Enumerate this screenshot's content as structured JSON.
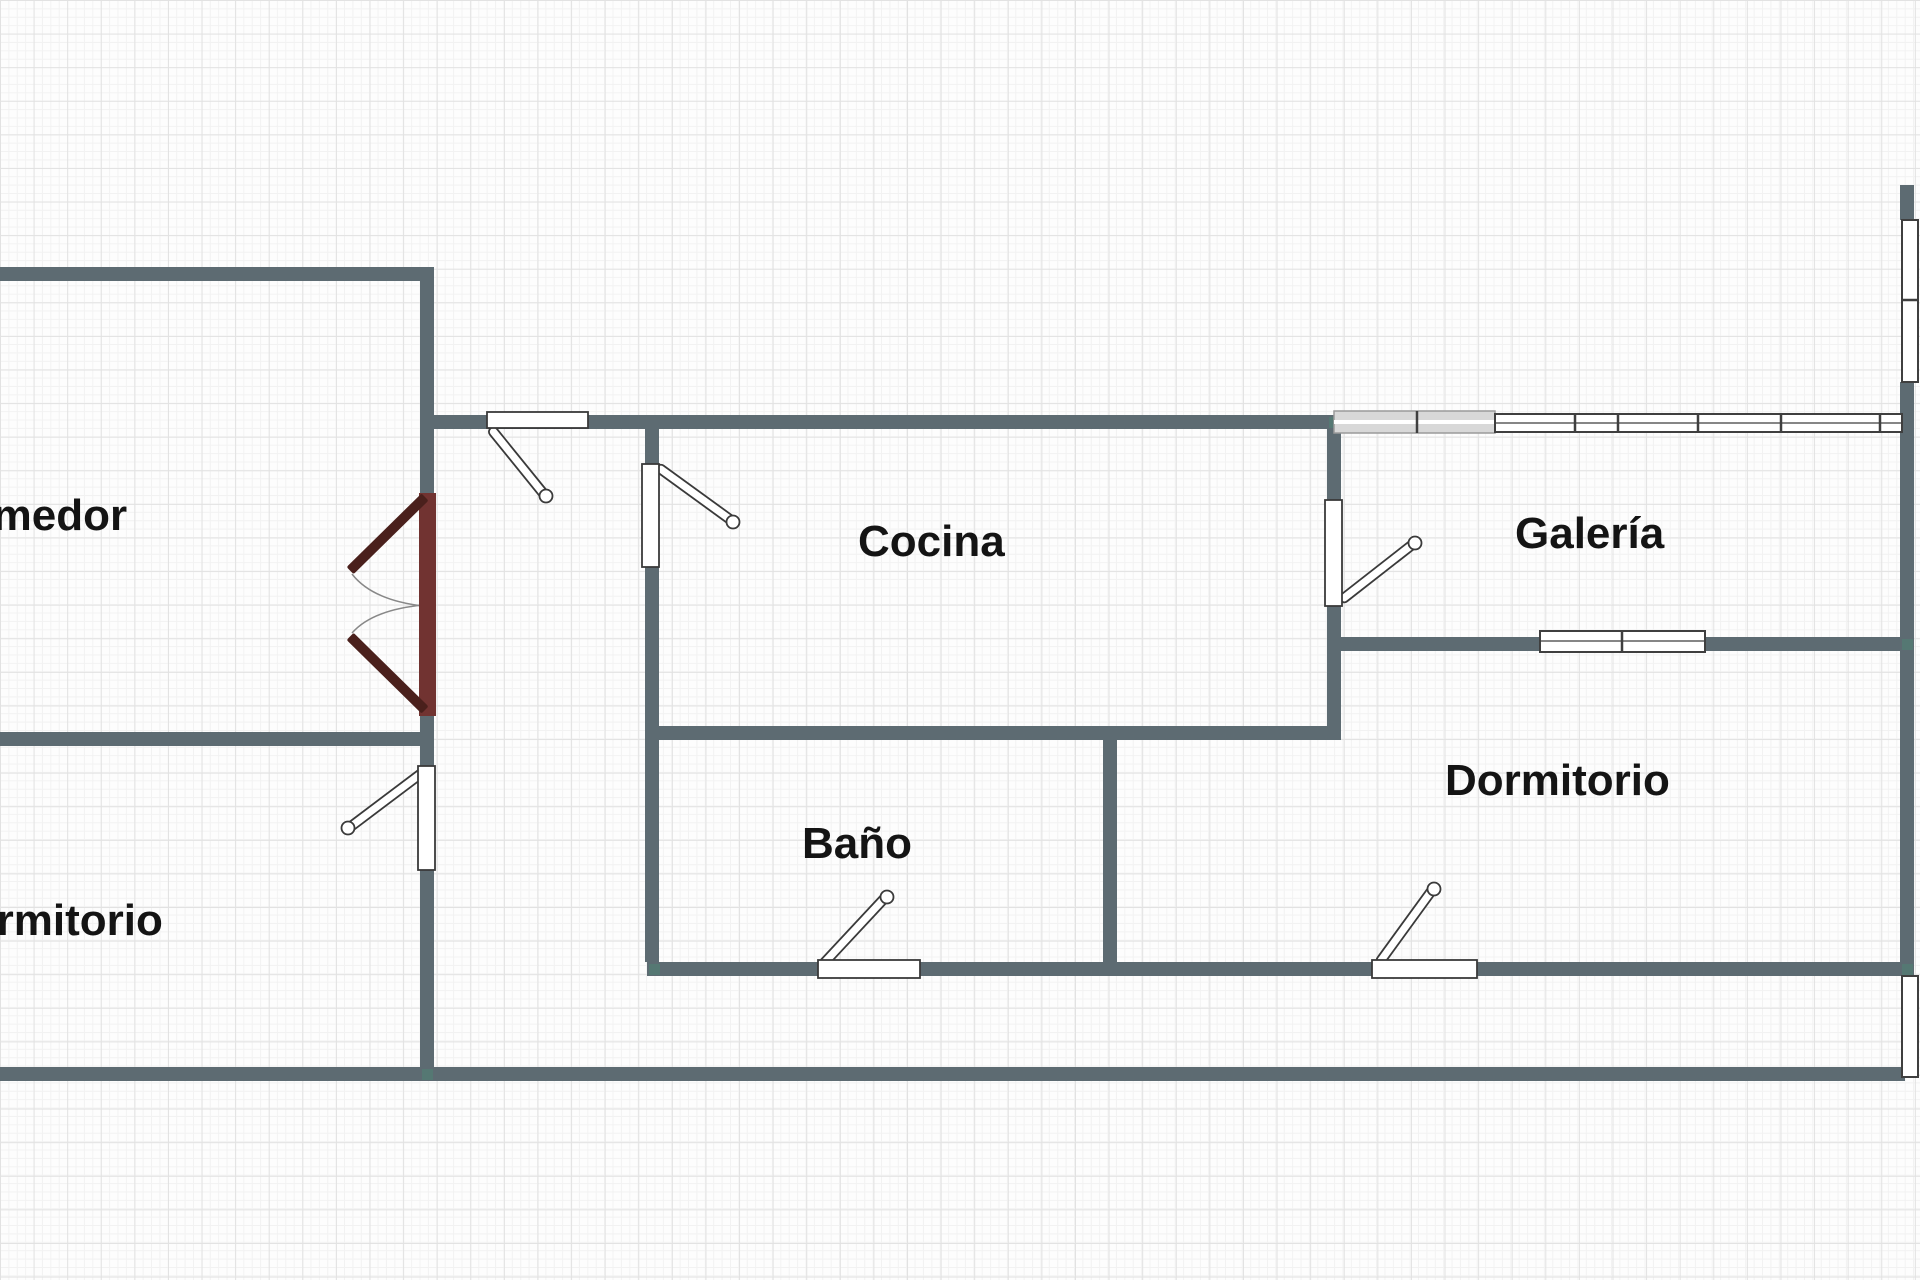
{
  "plan": {
    "type": "apartment-floor-plan",
    "rooms": [
      {
        "id": "comedor",
        "label": "Comedor"
      },
      {
        "id": "cocina",
        "label": "Cocina"
      },
      {
        "id": "galeria",
        "label": "Galería"
      },
      {
        "id": "bano",
        "label": "Baño"
      },
      {
        "id": "dormitorio_left",
        "label": "Dormitorio"
      },
      {
        "id": "dormitorio_right",
        "label": "Dormitorio"
      }
    ],
    "features": {
      "doors_single": 6,
      "doors_double_french": 1,
      "windows": 3,
      "wall_openings": 1
    }
  },
  "colors": {
    "wall": "#5d6b72",
    "door_frame": "#713331",
    "door_leaf": "#4a201c",
    "window_fill": "#ffffff",
    "window_frame": "#3f3f3f",
    "gray_window": "#d8d8d8",
    "accent_teal": "#4e8374",
    "grid_major": "#e2e2e2",
    "grid_minor": "#f2f2f2",
    "paper": "#fdfdfd",
    "label": "#141414"
  }
}
